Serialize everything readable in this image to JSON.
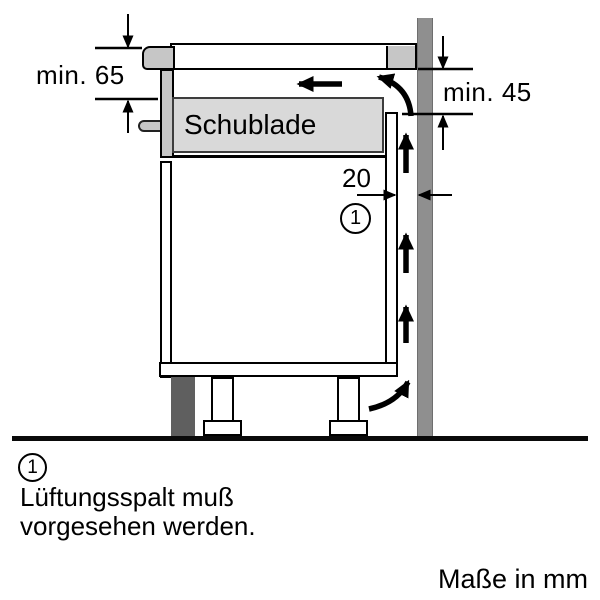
{
  "diagram": {
    "labels": {
      "drawer": "Schublade",
      "min_top_clearance": "min. 65",
      "min_side_clearance": "min. 45",
      "gap_width": "20",
      "callout": "1"
    },
    "colors": {
      "appliance_gray": "#c6c6c6",
      "drawer_fill_gray": "#d9d9d9",
      "wall_gray": "#8f8f8f",
      "plinth_dark_gray": "#5f5f5f",
      "line_black": "#000000",
      "background": "#ffffff"
    },
    "icons": {
      "airflow-left-arrow": "←",
      "airflow-up-arrow": "↑",
      "airflow-curve-top-arrow": "↖",
      "airflow-curve-bottom-arrow": "↗",
      "dimension-down-arrow": "↓",
      "dimension-up-arrow": "↑",
      "dimension-right-arrow": "→",
      "dimension-left-arrow": "←"
    }
  },
  "legend": {
    "callout": "1",
    "note_line1": "Lüftungsspalt muß",
    "note_line2": "vorgesehen werden.",
    "units": "Maße in mm"
  }
}
